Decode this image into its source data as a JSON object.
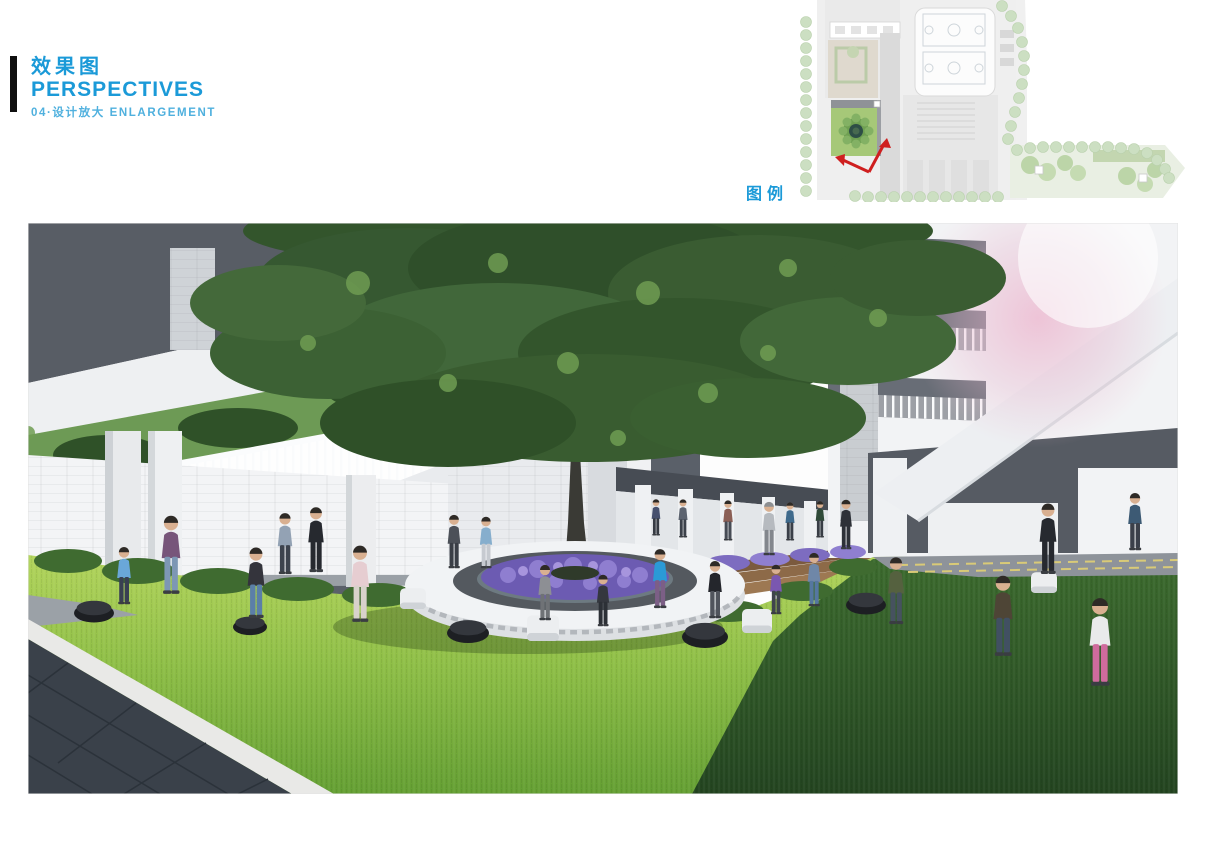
{
  "header": {
    "title_cn": "效果图",
    "title_en": "PERSPECTIVES",
    "subtitle": "04·设计放大 ENLARGEMENT"
  },
  "key_map": {
    "legend_label": "图例",
    "highlight": "courtyard-location-with-view-direction-arrows"
  },
  "colors": {
    "accent_blue": "#1b9ad8",
    "subtitle_blue": "#4fb0de",
    "title_bar_black": "#0f0f0f",
    "arrow_red": "#cf1f1f",
    "keymap_highlight_green": "#a6c878",
    "keymap_tree_green": "#ccdfc2",
    "keymap_building_gray": "#e7e7e7",
    "lawn_sunlit": "#9cc84a",
    "lawn_shadow": "#2f5527",
    "canopy_green": "#3c5f33",
    "flower_purple": "#7d6cc0",
    "soffit_gray": "#585d65",
    "wall_white": "#f2f3f5",
    "paving_dark": "#3a414a",
    "deck_wood": "#8a6847"
  },
  "rendering": {
    "description": "Perspective rendering of a school courtyard: large central tree in a circular planter bench ringed with purple flowers, children playing on a sunlit lawn, white colonnade buildings and an elevated walkway with railings around, dark stone paving at lower left",
    "figures": [
      {
        "x": 96,
        "y": 382,
        "h": 60,
        "shirt": "#6aa7d8",
        "pants": "#394052"
      },
      {
        "x": 143,
        "y": 372,
        "h": 82,
        "shirt": "#77557a",
        "pants": "#7d97b4"
      },
      {
        "x": 228,
        "y": 396,
        "h": 74,
        "shirt": "#34343c",
        "pants": "#5b7fa8"
      },
      {
        "x": 332,
        "y": 400,
        "h": 80,
        "shirt": "#e6cdd1",
        "pants": "#d8d2cb"
      },
      {
        "x": 257,
        "y": 352,
        "h": 64,
        "shirt": "#93a2b4",
        "pants": "#3d434e"
      },
      {
        "x": 288,
        "y": 350,
        "h": 68,
        "shirt": "#26292f",
        "pants": "#26292f"
      },
      {
        "x": 426,
        "y": 346,
        "h": 56,
        "shirt": "#4c5058",
        "pants": "#3a3e46"
      },
      {
        "x": 458,
        "y": 346,
        "h": 54,
        "shirt": "#86aecd",
        "pants": "#c6cad0"
      },
      {
        "x": 741,
        "y": 333,
        "h": 56,
        "shirt": "#b6babf",
        "pants": "#83878d",
        "hair": "#8d8f92"
      },
      {
        "x": 818,
        "y": 327,
        "h": 52,
        "shirt": "#2e3138",
        "pants": "#2e3138"
      },
      {
        "x": 655,
        "y": 315,
        "h": 40,
        "shirt": "#5d6470",
        "pants": "#3c414a"
      },
      {
        "x": 700,
        "y": 318,
        "h": 42,
        "shirt": "#8b5f55",
        "pants": "#474c55"
      },
      {
        "x": 628,
        "y": 313,
        "h": 38,
        "shirt": "#46506e",
        "pants": "#353a42"
      },
      {
        "x": 762,
        "y": 318,
        "h": 40,
        "shirt": "#3f6a8c",
        "pants": "#3a3f48"
      },
      {
        "x": 792,
        "y": 315,
        "h": 38,
        "shirt": "#2f4a38",
        "pants": "#383d45"
      },
      {
        "x": 517,
        "y": 398,
        "h": 58,
        "shirt": "#8d8f94",
        "pants": "#6f7276"
      },
      {
        "x": 575,
        "y": 404,
        "h": 54,
        "shirt": "#34373e",
        "pants": "#2c3036"
      },
      {
        "x": 632,
        "y": 386,
        "h": 62,
        "shirt": "#2b9ad6",
        "pants": "#7c5f86"
      },
      {
        "x": 687,
        "y": 396,
        "h": 60,
        "shirt": "#24262c",
        "pants": "#50545c"
      },
      {
        "x": 748,
        "y": 392,
        "h": 52,
        "shirt": "#7a57b0",
        "pants": "#3f444d"
      },
      {
        "x": 786,
        "y": 384,
        "h": 56,
        "shirt": "#6f87a8",
        "pants": "#5577a0"
      },
      {
        "x": 868,
        "y": 402,
        "h": 70,
        "shirt": "#55613f",
        "pants": "#46525f"
      },
      {
        "x": 975,
        "y": 434,
        "h": 84,
        "shirt": "#4e4536",
        "pants": "#415062"
      },
      {
        "x": 1072,
        "y": 464,
        "h": 92,
        "shirt": "#e9eaeb",
        "pants": "#cf6b9d"
      },
      {
        "x": 1020,
        "y": 352,
        "h": 74,
        "shirt": "#26292f",
        "pants": "#26292f"
      },
      {
        "x": 1107,
        "y": 328,
        "h": 60,
        "shirt": "#3d5a74",
        "pants": "#3b404a"
      }
    ],
    "seats": {
      "white_cubes": [
        {
          "x": 385,
          "y": 386,
          "w": 26
        },
        {
          "x": 515,
          "y": 418,
          "w": 32
        },
        {
          "x": 729,
          "y": 410,
          "w": 30
        },
        {
          "x": 1016,
          "y": 370,
          "w": 26
        }
      ],
      "black_poufs": [
        {
          "x": 66,
          "y": 390,
          "w": 40
        },
        {
          "x": 222,
          "y": 404,
          "w": 34
        },
        {
          "x": 440,
          "y": 410,
          "w": 42
        },
        {
          "x": 677,
          "y": 414,
          "w": 46
        },
        {
          "x": 838,
          "y": 382,
          "w": 40
        }
      ]
    }
  }
}
